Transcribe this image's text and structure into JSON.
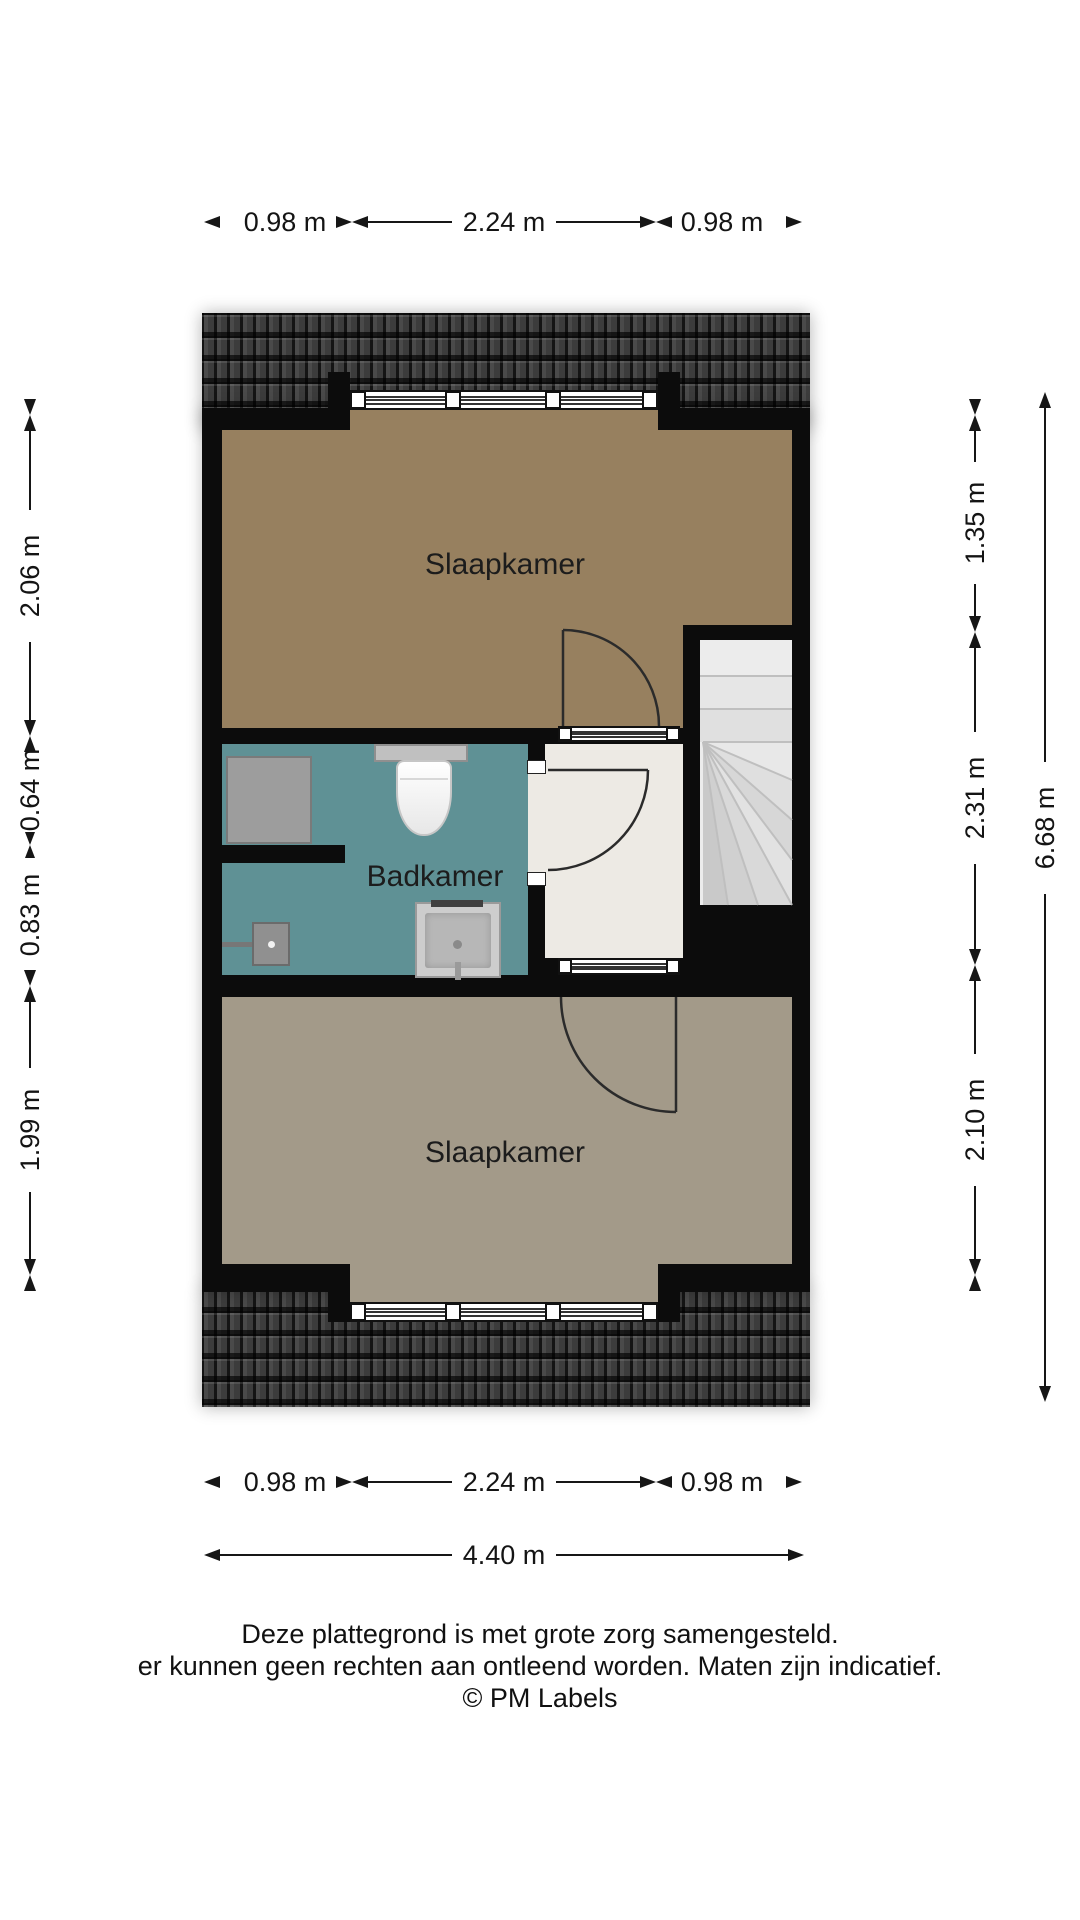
{
  "rooms": {
    "bedroom_top": "Slaapkamer",
    "bathroom": "Badkamer",
    "bedroom_bottom": "Slaapkamer"
  },
  "dimensions": {
    "top": [
      "0.98 m",
      "2.24 m",
      "0.98 m"
    ],
    "bottom": [
      "0.98 m",
      "2.24 m",
      "0.98 m"
    ],
    "bottom_total": "4.40 m",
    "left": [
      "2.06 m",
      "0.64 m",
      "0.83 m",
      "1.99 m"
    ],
    "right": [
      "1.35 m",
      "2.31 m",
      "2.10 m"
    ],
    "right_total": "6.68 m"
  },
  "footer": {
    "line1": "Deze plattegrond is met grote zorg samengesteld.",
    "line2": "er kunnen geen rechten aan ontleend worden. Maten zijn indicatief.",
    "line3": "© PM Labels"
  },
  "colors": {
    "bedroom_top": "#97805f",
    "bedroom_bottom": "#a39a89",
    "bathroom": "#5f9195",
    "hall": "#edeae4",
    "wall": "#0c0c0c",
    "stairs": "#e3e3e3",
    "roof": "#383838"
  }
}
